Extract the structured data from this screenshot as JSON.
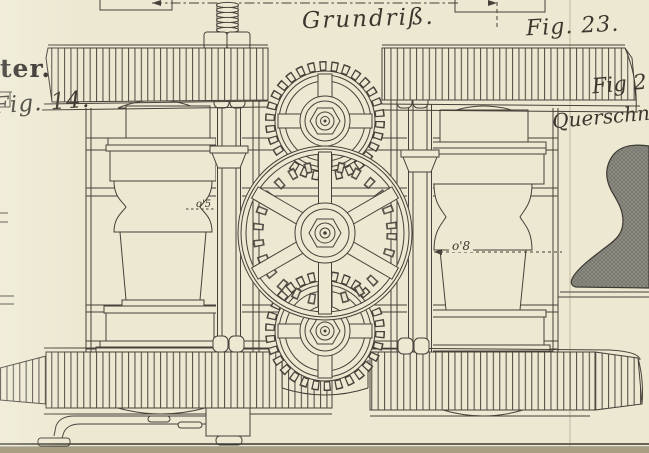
{
  "figure": {
    "plan_title": "Grundriß.",
    "fig23_label": "Fig. 23.",
    "left_caption_fragment": "ter.",
    "fig14_label": "Fig. 14.",
    "fig24_label": "Fig 2",
    "querschnitt_label": "Querschnitt",
    "dim_left": "o'5",
    "dim_right": "o'8"
  },
  "colors": {
    "paper": "#ece8d1",
    "ink": "#46413a",
    "section_fill": "#8e8d84",
    "table_below_plate": "#a89f82"
  }
}
